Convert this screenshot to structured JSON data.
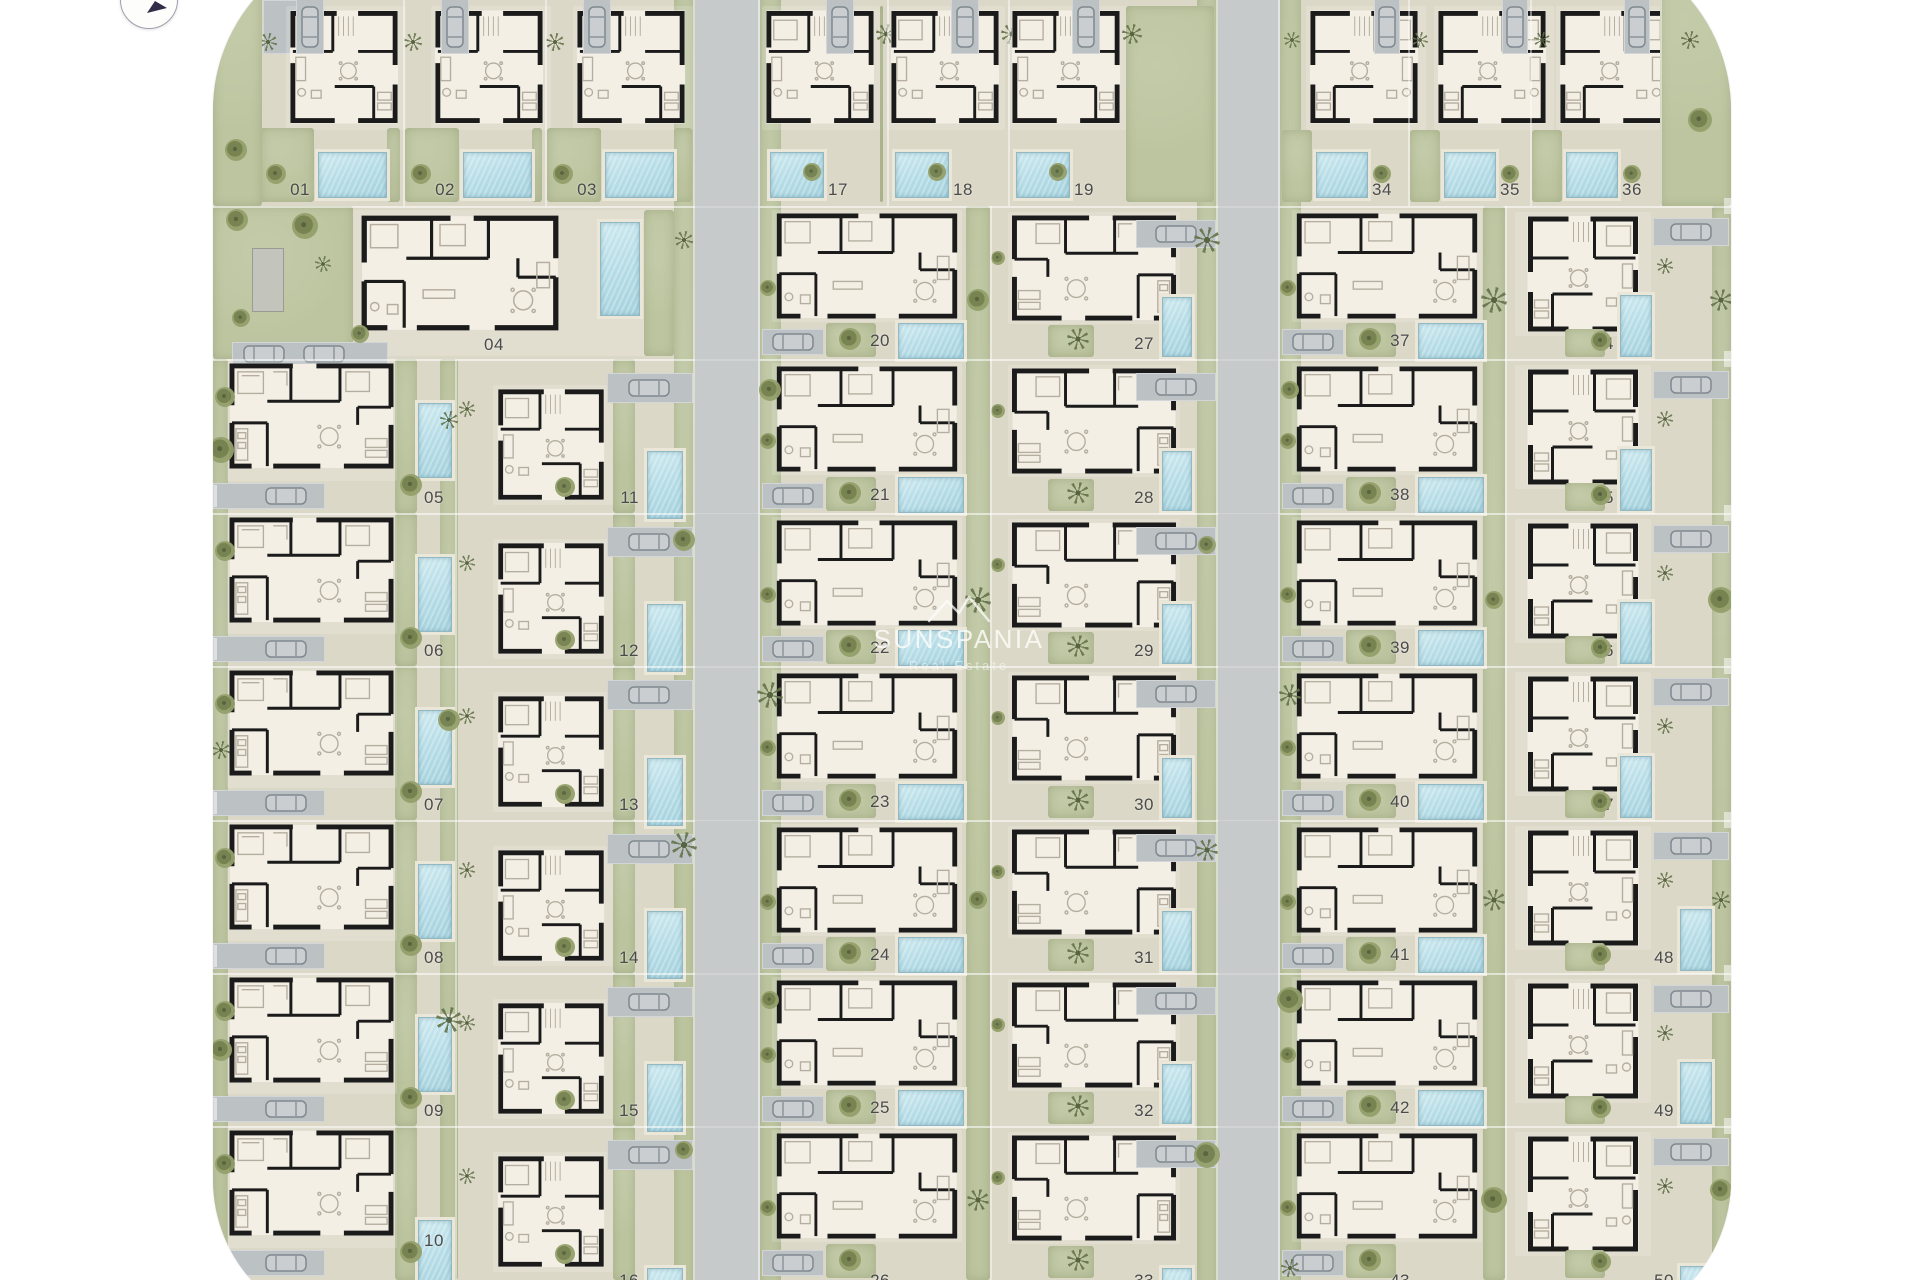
{
  "watermark": {
    "brand": "SUNSPANIA",
    "tagline": "Real Estate"
  },
  "plots": {
    "col1_top": [
      "01",
      "02",
      "03"
    ],
    "special": "04",
    "col1_left": [
      "05",
      "06",
      "07",
      "08",
      "09",
      "10"
    ],
    "col1_right": [
      "11",
      "12",
      "13",
      "14",
      "15",
      "16"
    ],
    "col2_top": [
      "17",
      "18",
      "19"
    ],
    "col2_left": [
      "20",
      "21",
      "22",
      "23",
      "24",
      "25",
      "26"
    ],
    "col2_right": [
      "27",
      "28",
      "29",
      "30",
      "31",
      "32",
      "33"
    ],
    "col3_top": [
      "34",
      "35",
      "36"
    ],
    "col3_left": [
      "37",
      "38",
      "39",
      "40",
      "41",
      "42",
      "43"
    ],
    "col3_right": [
      "44",
      "45",
      "46",
      "47",
      "48",
      "49",
      "50"
    ]
  },
  "palette": {
    "site_base": "#dcd8c7",
    "road": "#c7cacb",
    "green": "#bdc5a0",
    "pool": "#b7dde7",
    "wall": "#1b1b1b",
    "house_fill": "#f3efe5",
    "number_text": "#4a4a4a"
  }
}
